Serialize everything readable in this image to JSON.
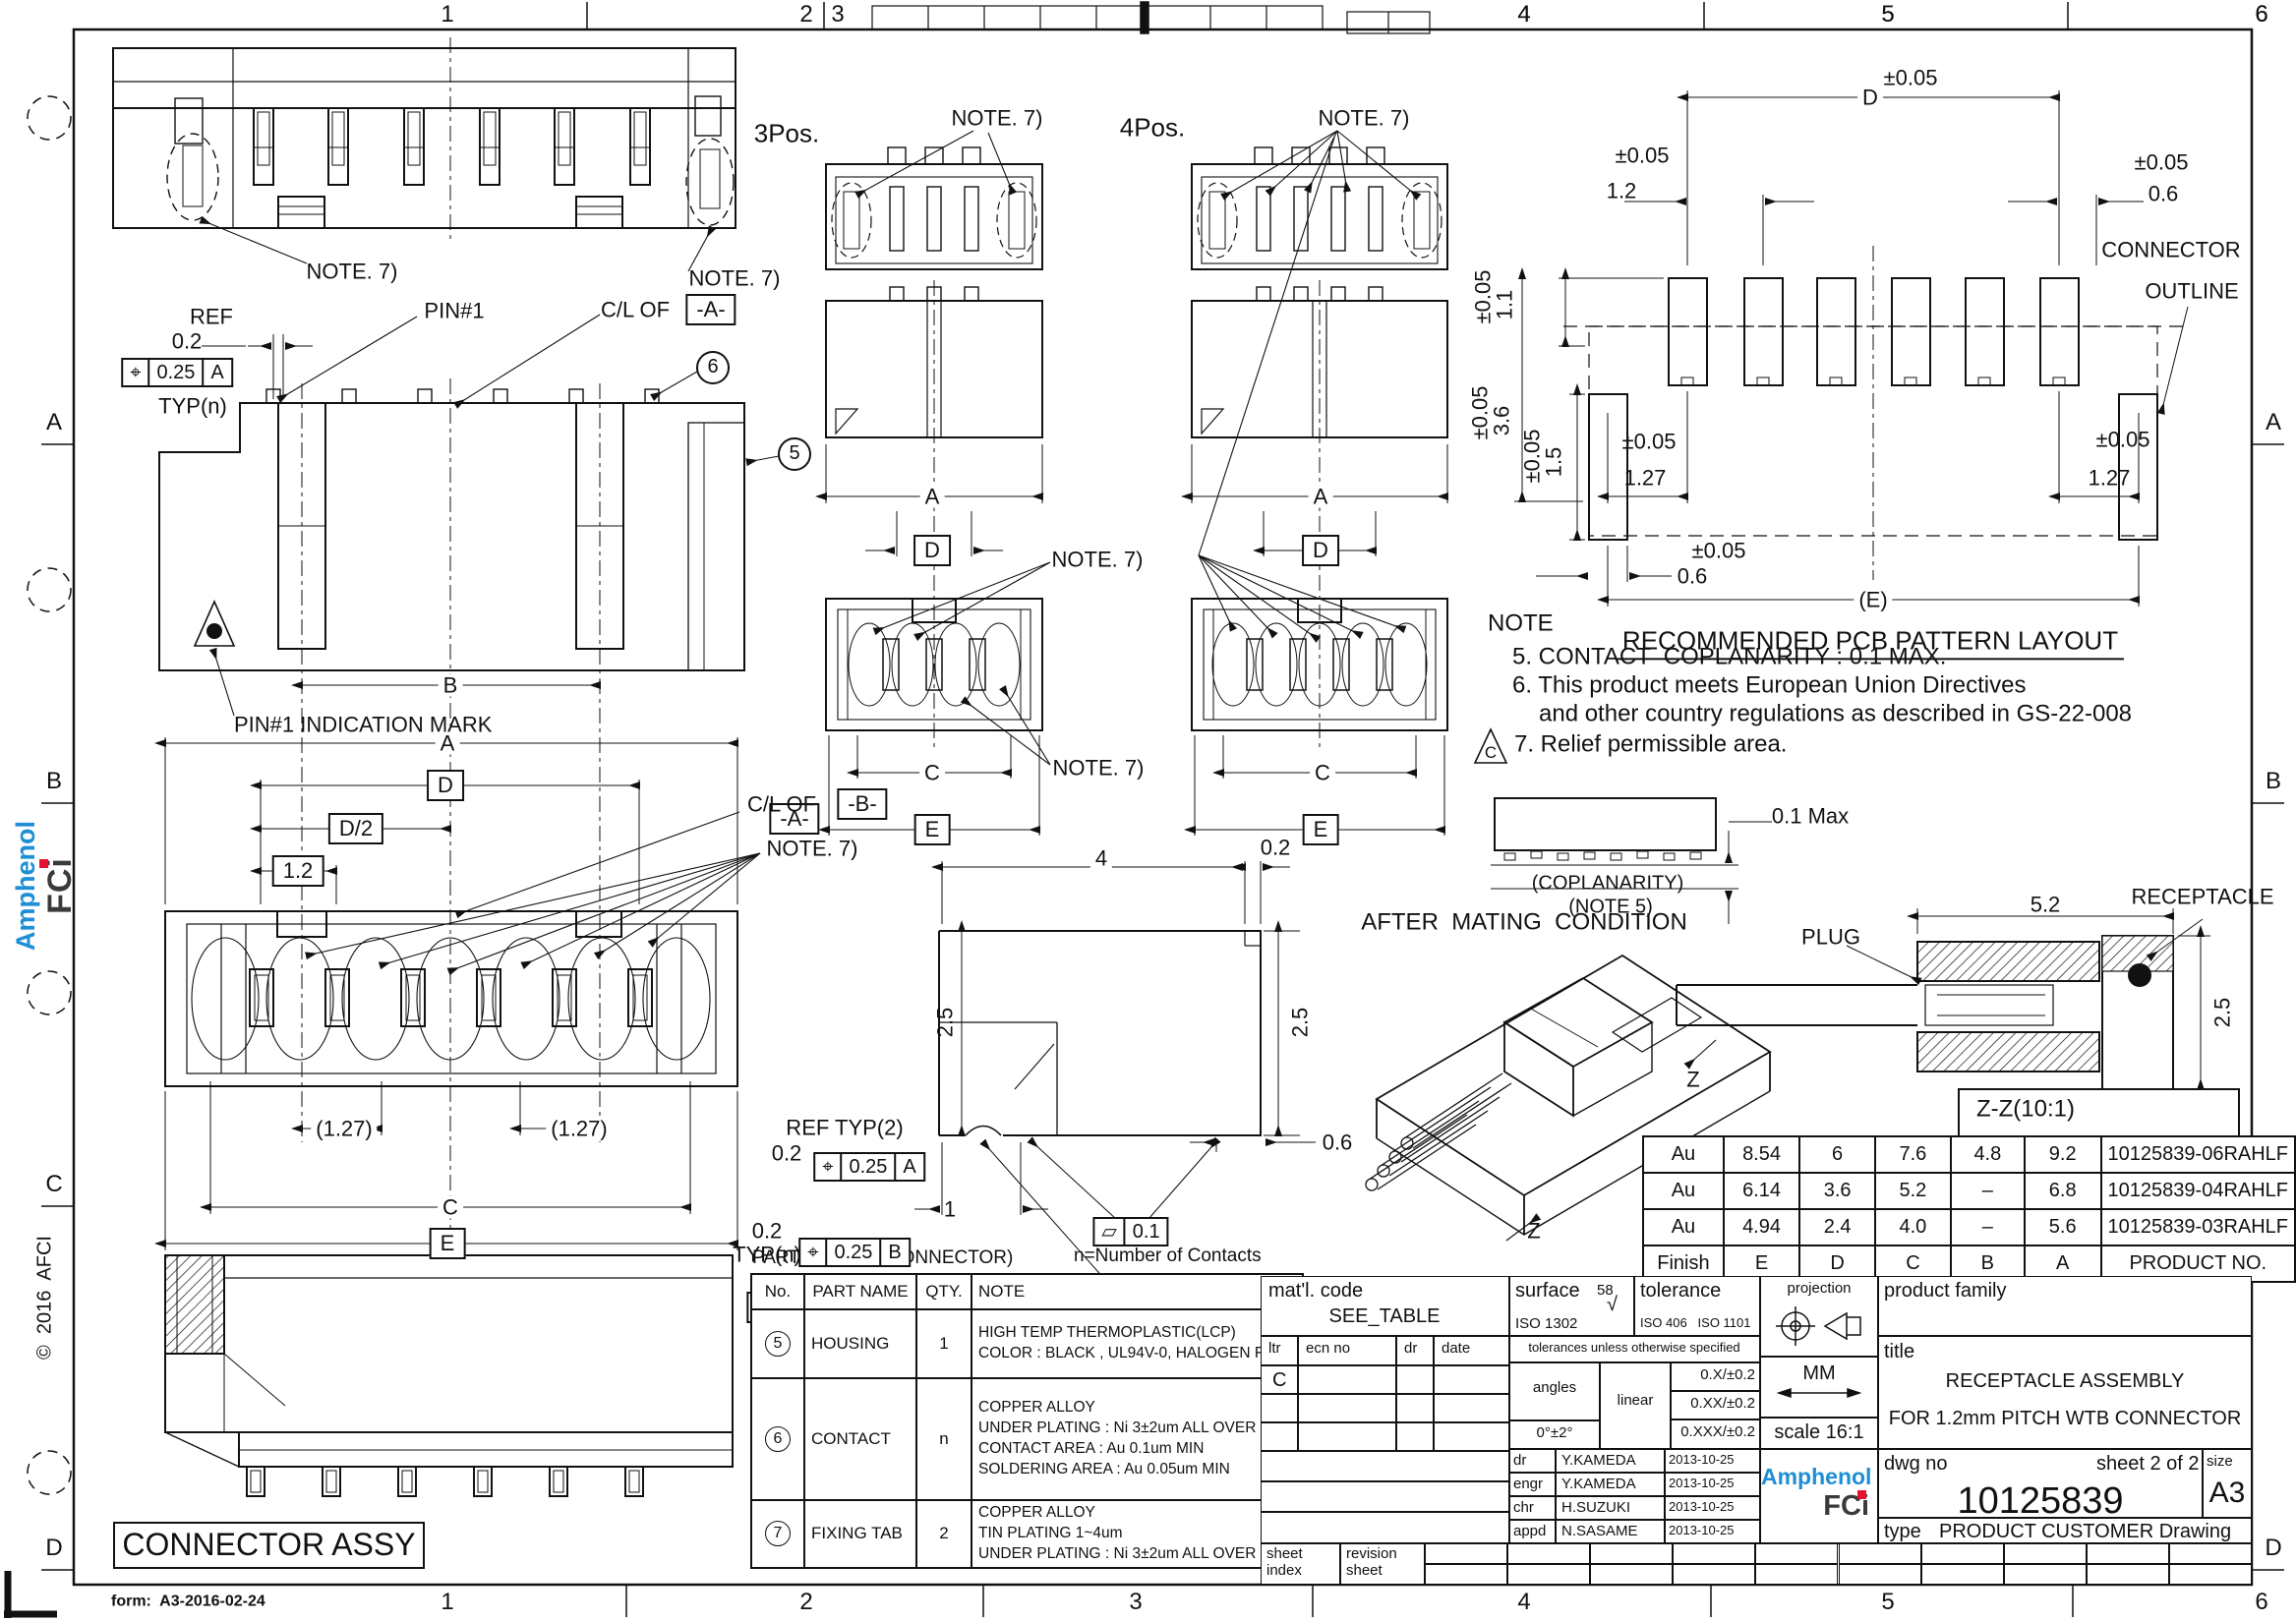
{
  "sheet": {
    "form": "form:  A3-2016-02-24",
    "copyright": "©  2016  AFCI",
    "zones_top": [
      "1",
      "2",
      "3",
      "4",
      "5",
      "6"
    ],
    "zones_bottom": [
      "1",
      "2",
      "3",
      "4",
      "5",
      "6"
    ],
    "zones_left": [
      "A",
      "B",
      "C",
      "D"
    ],
    "zones_right": [
      "A",
      "B",
      "C",
      "D"
    ],
    "brand_blue": "#1e8fd5",
    "brand_red": "#e8112d"
  },
  "labels": {
    "note7": "NOTE. 7)",
    "pos3": "3Pos.",
    "pos4": "4Pos.",
    "ref": "REF",
    "d02": "0.2",
    "d025": "0.25",
    "datumA": "A",
    "datumB": "B",
    "typn": "TYP(n)",
    "reftyp2": "REF TYP(2)",
    "pin1": "PIN#1",
    "clof": "C/L OF",
    "boxA": "-A-",
    "boxB": "-B-",
    "pin1mark": "PIN#1 INDICATION MARK",
    "dimA": "A",
    "dimB": "B",
    "dimC": "C",
    "dimD": "D",
    "dimD2": "D/2",
    "dim12": "1.2",
    "dim127p": "(1.27)",
    "dimE": "E",
    "dimEp": "(E)",
    "c5": "5",
    "c6": "6",
    "c7": "7",
    "dim4": "4",
    "dim25": "2.5",
    "dim1": "1",
    "dim06": "0.6",
    "dim01": "0.1",
    "possym": "⌖",
    "flatsym": "▱",
    "pm005": "±0.05",
    "dim11": "1.1",
    "dim36": "3.6",
    "dim15": "1.5",
    "dim127": "1.27",
    "connector_line1": "CONNECTOR",
    "connector_line2": "OUTLINE",
    "pcb_title": "RECOMMENDED PCB PATTERN LAYOUT",
    "note_h": "NOTE",
    "note5": "5. CONTACT  COPLANARITY : 0.1 MAX.",
    "note6a": "6. This product meets European Union Directives",
    "note6b": "and other country regulations as described in GS-22-008",
    "note7t": "7. Relief permissible area.",
    "triC": "C",
    "cop01": "0.1 Max",
    "cop1": "(COPLANARITY)",
    "cop2": "(NOTE 5)",
    "mating": "AFTER  MATING  CONDITION",
    "z": "Z",
    "plug": "PLUG",
    "dim52": "5.2",
    "receptacle": "RECEPTACLE",
    "zz": "Z-Z(10:1)",
    "assy": "CONNECTOR ASSY"
  },
  "finish_table": {
    "rows": [
      [
        "Au",
        "8.54",
        "6",
        "7.6",
        "4.8",
        "9.2",
        "10125839-06RAHLF"
      ],
      [
        "Au",
        "6.14",
        "3.6",
        "5.2",
        "–",
        "6.8",
        "10125839-04RAHLF"
      ],
      [
        "Au",
        "4.94",
        "2.4",
        "4.0",
        "–",
        "5.6",
        "10125839-03RAHLF"
      ],
      [
        "Finish",
        "E",
        "D",
        "C",
        "B",
        "A",
        "PRODUCT NO."
      ]
    ]
  },
  "parts_table": {
    "title": "PARTS TABLE (CONNECTOR)",
    "subtitle": "n=Number of Contacts",
    "headers": [
      "No.",
      "PART NAME",
      "QTY.",
      "NOTE"
    ],
    "rows": [
      {
        "no": "5",
        "name": "HOUSING",
        "qty": "1",
        "note": "HIGH TEMP THERMOPLASTIC(LCP)\nCOLOR : BLACK , UL94V-0, HALOGEN FREE"
      },
      {
        "no": "6",
        "name": "CONTACT",
        "qty": "n",
        "note": "COPPER ALLOY\nUNDER PLATING : Ni 3±2um ALL OVER\nCONTACT AREA : Au 0.1um MIN\nSOLDERING AREA : Au 0.05um MIN"
      },
      {
        "no": "7",
        "name": "FIXING TAB",
        "qty": "2",
        "note": "COPPER ALLOY\nTIN PLATING 1~4um\nUNDER PLATING : Ni 3±2um ALL OVER"
      }
    ]
  },
  "title_block": {
    "matl_label": "mat'l. code",
    "matl_value": "SEE_TABLE",
    "surface_label": "surface",
    "surface_num": "58",
    "surface_check": "√",
    "surface_iso": "ISO 1302",
    "tol_label": "tolerance",
    "tol_iso": "ISO 406   ISO 1101",
    "rev_headers": [
      "ltr",
      "ecn no",
      "dr",
      "date"
    ],
    "rev_row": "C",
    "tol_note": "tolerances unless otherwise specified",
    "angles": "angles",
    "linear": "linear",
    "angle_tol": "0°±2°",
    "tols": [
      "0.X/±0.2",
      "0.XX/±0.2",
      "0.XXX/±0.2"
    ],
    "projection_label": "projection",
    "units": "MM",
    "scale": "scale 16:1",
    "product_family_label": "product family",
    "title_label": "title",
    "title1": "RECEPTACLE ASSEMBLY",
    "title2": "FOR 1.2mm PITCH WTB CONNECTOR",
    "sig_rows": [
      [
        "dr",
        "Y.KAMEDA",
        "2013-10-25"
      ],
      [
        "engr",
        "Y.KAMEDA",
        "2013-10-25"
      ],
      [
        "chr",
        "H.SUZUKI",
        "2013-10-25"
      ],
      [
        "appd",
        "N.SASAME",
        "2013-10-25"
      ]
    ],
    "dwg_label": "dwg no",
    "sheet_label": "sheet 2 of 2",
    "size_label": "size",
    "dwg_no": "10125839",
    "size": "A3",
    "type_label": "type",
    "type_value": "PRODUCT CUSTOMER Drawing",
    "strip1a": "sheet",
    "strip1b": "index",
    "strip2a": "revision",
    "strip2b": "sheet",
    "brand1": "Amphenol",
    "brand2": "FCi"
  }
}
